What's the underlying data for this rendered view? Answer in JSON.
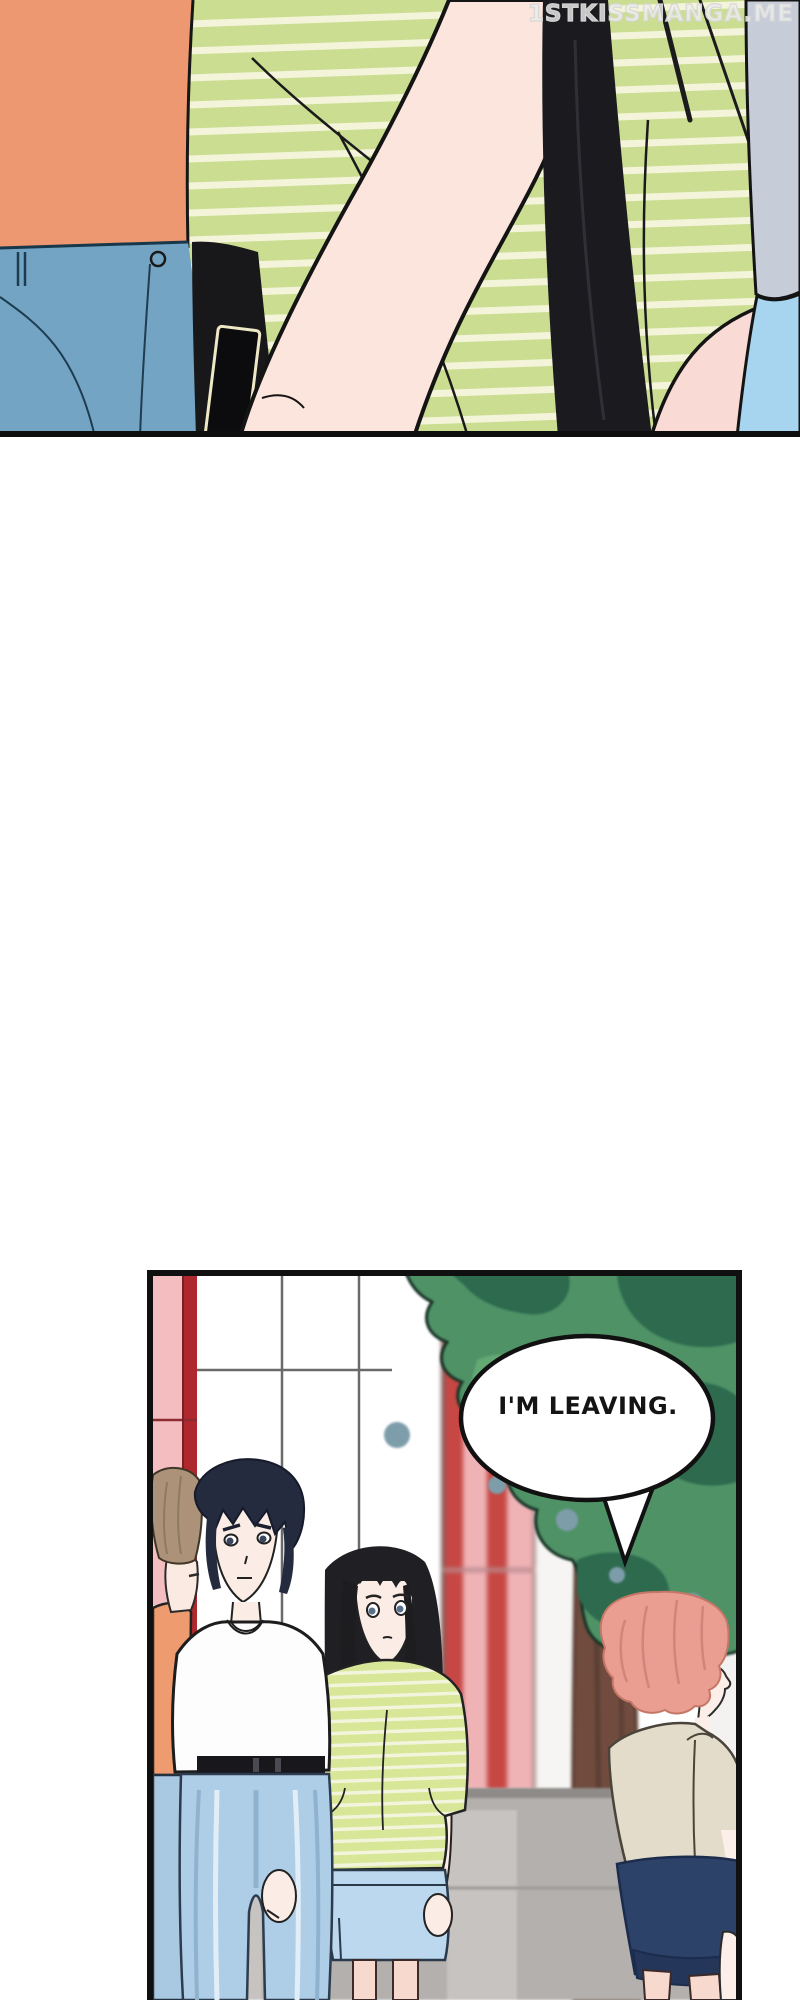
{
  "watermark": {
    "text": "1STKISSMANGA.ME"
  },
  "panel_1": {
    "description": "close-up of person in green striped shirt with long black hair, orange-shirt person in jeans at left"
  },
  "panel_2": {
    "speech_bubble": {
      "text": "I'M LEAVING."
    },
    "description": "courtyard scene: man in white tee, girl in green striped tee, pink-haired person walking away past a tree"
  },
  "palette": {
    "stripe_shirt_green": "#CBDD90",
    "stripe_cream": "#F4F4DB",
    "orange_shirt": "#ED9870",
    "jeans_blue": "#74A4C4",
    "light_jeans_blue": "#AECDE7",
    "hair_black": "#1B1B1F",
    "hair_navy": "#242B3E",
    "hair_tan": "#AB9278",
    "hair_pink": "#E99E91",
    "skin_light": "#FBE5DD",
    "pillar_pink": "#F4BEC1",
    "pillar_red": "#AF282E",
    "blurred_red": "#C64743",
    "tree_green_mid": "#4F9266",
    "tree_green_dark": "#2D6A4E",
    "trunk_brown": "#714C3E",
    "stone_gray": "#B3B0AD",
    "beige_shirt": "#E4DCCA",
    "navy_skirt": "#2D4268",
    "sky_lavender": "#C7CCD9",
    "light_blue": "#A7D4EE",
    "panel_border": "#101010"
  }
}
